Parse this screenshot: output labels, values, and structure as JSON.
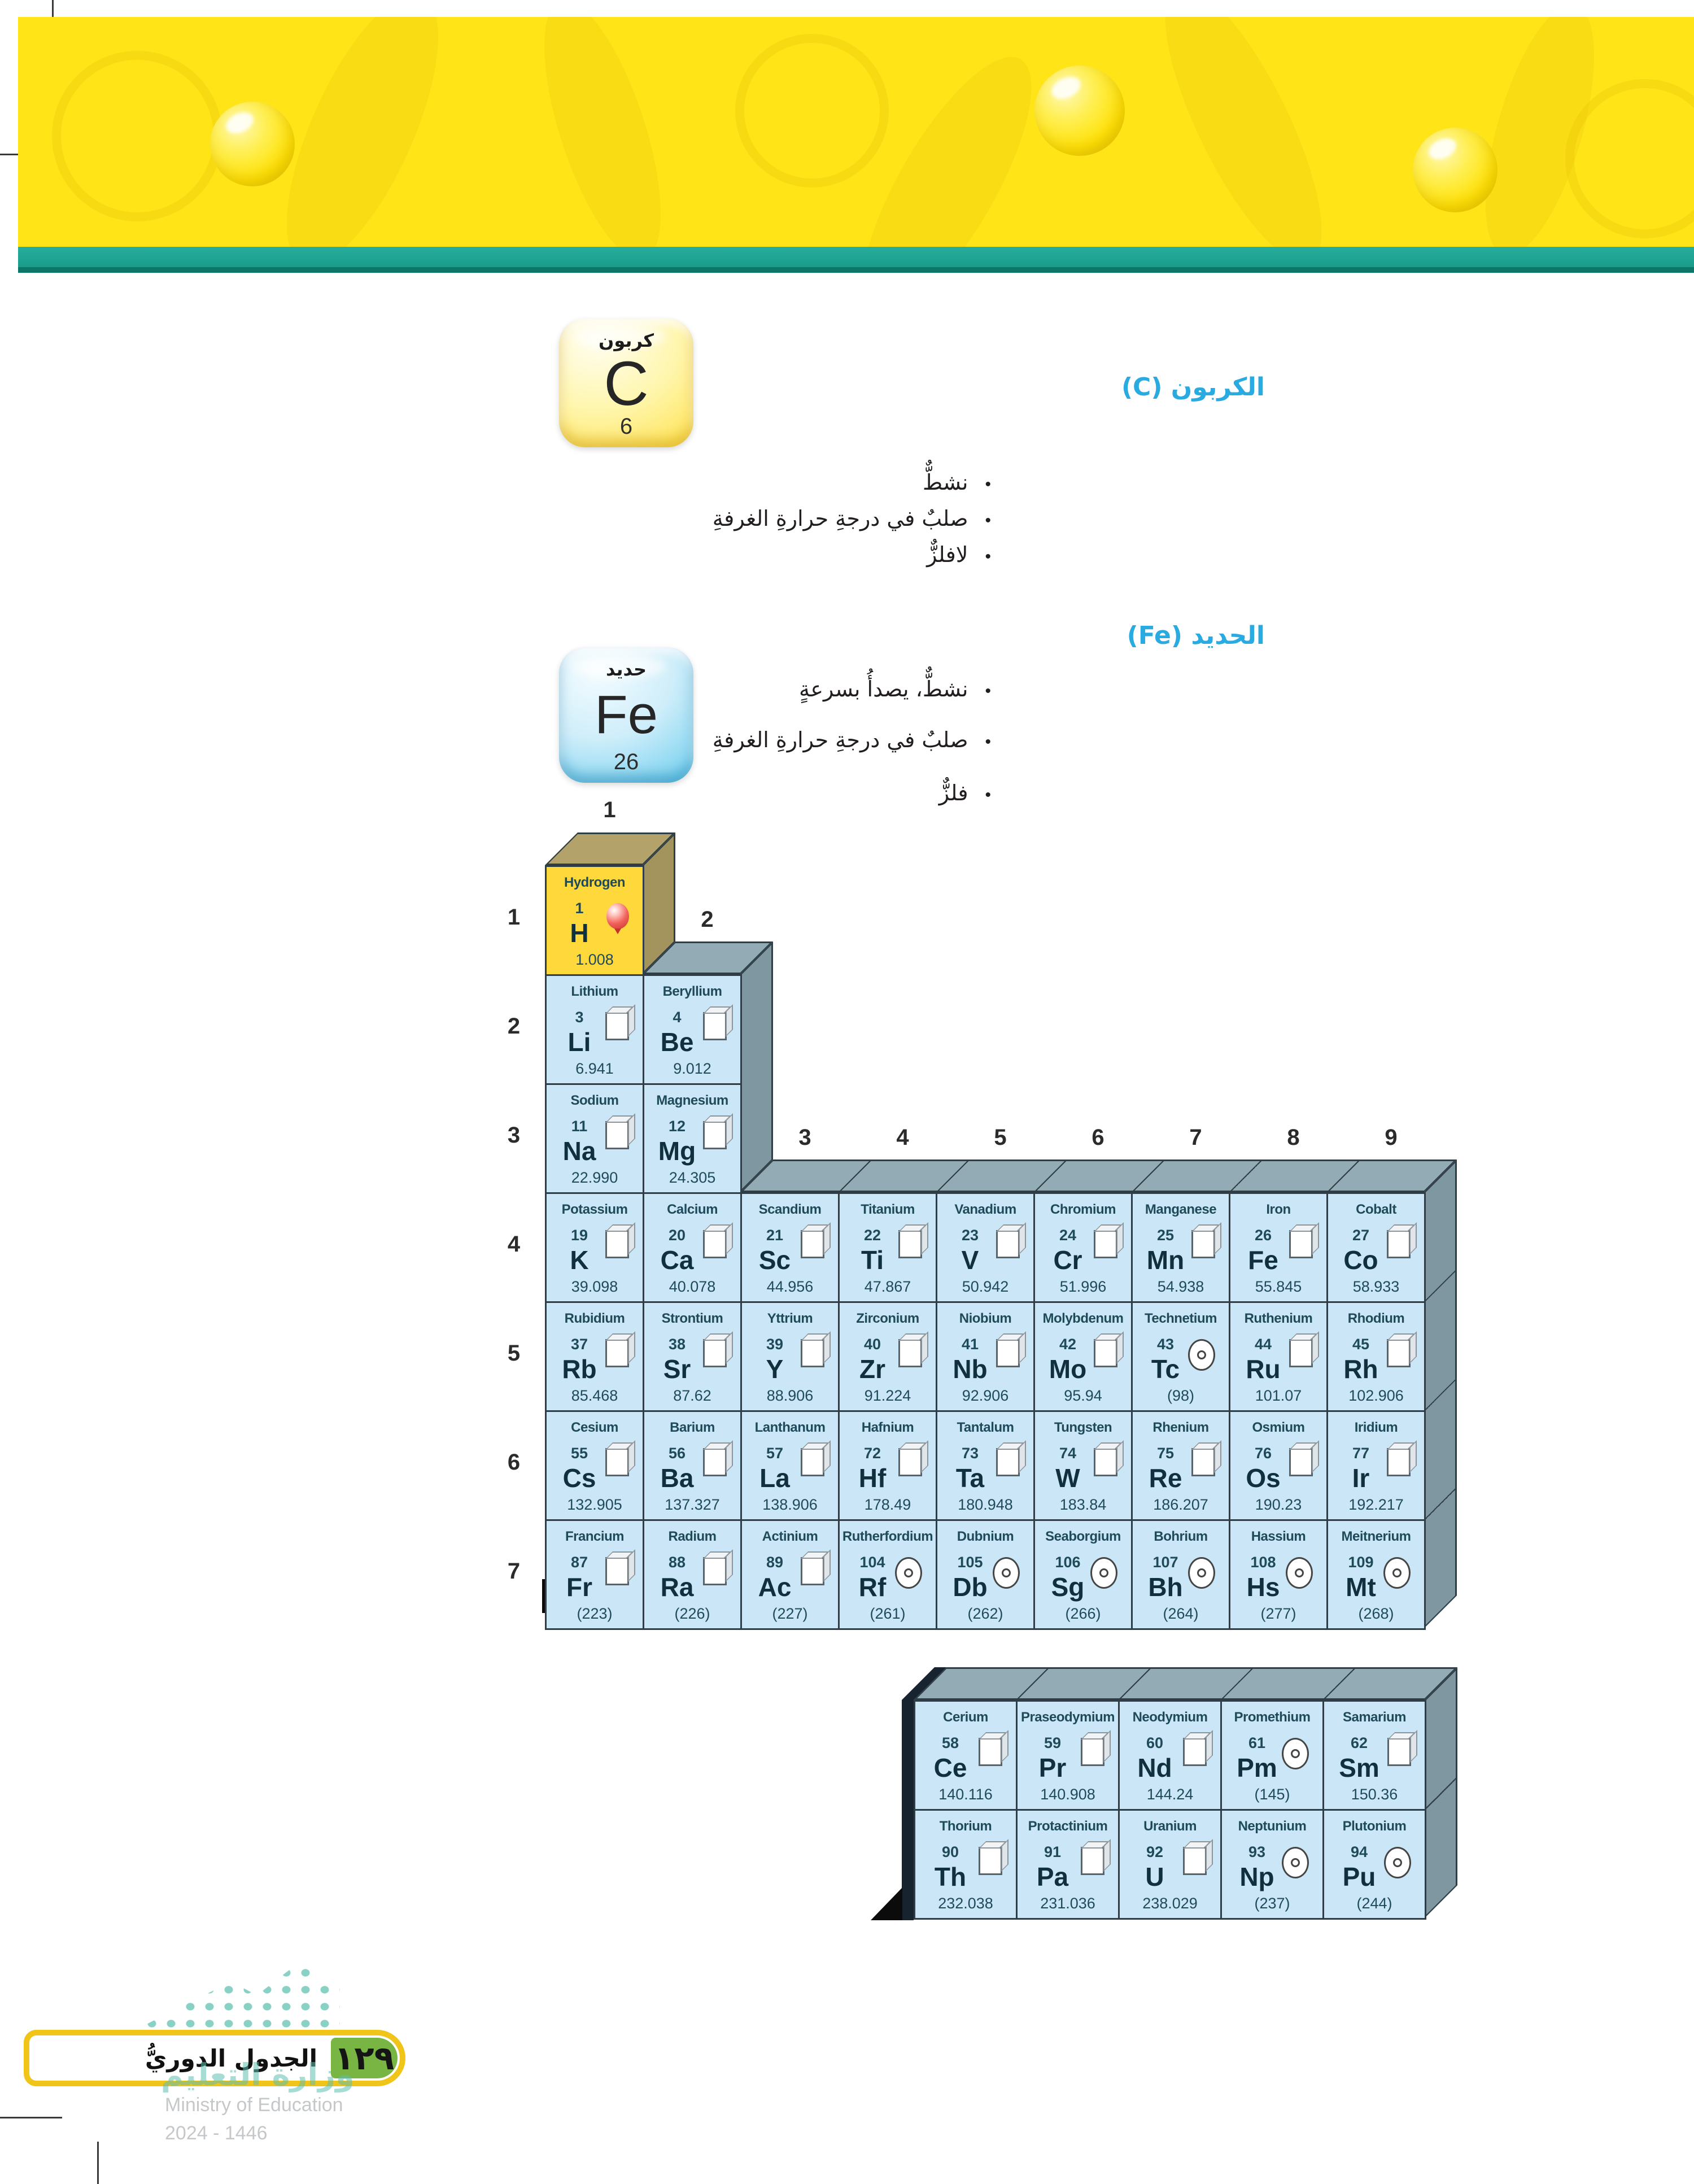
{
  "colors": {
    "banner_yellow": "#FFE418",
    "stripe_teal": "#1A9C8B",
    "heading_blue": "#29ABE2",
    "cell_blue": "#CBE7F7",
    "hydrogen_yellow": "#FFD83C",
    "table_3d_gray": "#93ABB5",
    "badge_green": "#79B543",
    "footer_border_yellow": "#F0C419"
  },
  "carbon_section": {
    "heading": "الكربون (C)",
    "bullets": [
      "نشطٌّ",
      "صلبٌ في درجةِ حرارةِ الغرفةِ",
      "لافلزٌّ"
    ],
    "card": {
      "name_ar": "كربون",
      "symbol": "C",
      "number": "6"
    }
  },
  "iron_section": {
    "heading": "الحديد (Fe)",
    "bullets": [
      "نشطٌّ، يصدأُ بسرعةٍ",
      "صلبٌ في درجةِ حرارةِ الغرفةِ",
      "فلزٌّ"
    ],
    "card": {
      "name_ar": "حديد",
      "symbol": "Fe",
      "number": "26"
    }
  },
  "periodic_table": {
    "group_labels": [
      "1",
      "2",
      "3",
      "4",
      "5",
      "6",
      "7",
      "8",
      "9"
    ],
    "period_labels": [
      "1",
      "2",
      "3",
      "4",
      "5",
      "6",
      "7"
    ],
    "legend_icons": [
      "solid-cube-icon",
      "gas-balloon-icon",
      "synthetic-bullseye-icon"
    ],
    "elements": [
      {
        "period": 1,
        "group": 1,
        "name": "Hydrogen",
        "number": "1",
        "symbol": "H",
        "mass": "1.008",
        "icon": "balloon",
        "variant": "yellow"
      },
      {
        "period": 2,
        "group": 1,
        "name": "Lithium",
        "number": "3",
        "symbol": "Li",
        "mass": "6.941",
        "icon": "cube"
      },
      {
        "period": 2,
        "group": 2,
        "name": "Beryllium",
        "number": "4",
        "symbol": "Be",
        "mass": "9.012",
        "icon": "cube"
      },
      {
        "period": 3,
        "group": 1,
        "name": "Sodium",
        "number": "11",
        "symbol": "Na",
        "mass": "22.990",
        "icon": "cube"
      },
      {
        "period": 3,
        "group": 2,
        "name": "Magnesium",
        "number": "12",
        "symbol": "Mg",
        "mass": "24.305",
        "icon": "cube"
      },
      {
        "period": 4,
        "group": 1,
        "name": "Potassium",
        "number": "19",
        "symbol": "K",
        "mass": "39.098",
        "icon": "cube"
      },
      {
        "period": 4,
        "group": 2,
        "name": "Calcium",
        "number": "20",
        "symbol": "Ca",
        "mass": "40.078",
        "icon": "cube"
      },
      {
        "period": 4,
        "group": 3,
        "name": "Scandium",
        "number": "21",
        "symbol": "Sc",
        "mass": "44.956",
        "icon": "cube"
      },
      {
        "period": 4,
        "group": 4,
        "name": "Titanium",
        "number": "22",
        "symbol": "Ti",
        "mass": "47.867",
        "icon": "cube"
      },
      {
        "period": 4,
        "group": 5,
        "name": "Vanadium",
        "number": "23",
        "symbol": "V",
        "mass": "50.942",
        "icon": "cube"
      },
      {
        "period": 4,
        "group": 6,
        "name": "Chromium",
        "number": "24",
        "symbol": "Cr",
        "mass": "51.996",
        "icon": "cube"
      },
      {
        "period": 4,
        "group": 7,
        "name": "Manganese",
        "number": "25",
        "symbol": "Mn",
        "mass": "54.938",
        "icon": "cube"
      },
      {
        "period": 4,
        "group": 8,
        "name": "Iron",
        "number": "26",
        "symbol": "Fe",
        "mass": "55.845",
        "icon": "cube"
      },
      {
        "period": 4,
        "group": 9,
        "name": "Cobalt",
        "number": "27",
        "symbol": "Co",
        "mass": "58.933",
        "icon": "cube"
      },
      {
        "period": 5,
        "group": 1,
        "name": "Rubidium",
        "number": "37",
        "symbol": "Rb",
        "mass": "85.468",
        "icon": "cube"
      },
      {
        "period": 5,
        "group": 2,
        "name": "Strontium",
        "number": "38",
        "symbol": "Sr",
        "mass": "87.62",
        "icon": "cube"
      },
      {
        "period": 5,
        "group": 3,
        "name": "Yttrium",
        "number": "39",
        "symbol": "Y",
        "mass": "88.906",
        "icon": "cube"
      },
      {
        "period": 5,
        "group": 4,
        "name": "Zirconium",
        "number": "40",
        "symbol": "Zr",
        "mass": "91.224",
        "icon": "cube"
      },
      {
        "period": 5,
        "group": 5,
        "name": "Niobium",
        "number": "41",
        "symbol": "Nb",
        "mass": "92.906",
        "icon": "cube"
      },
      {
        "period": 5,
        "group": 6,
        "name": "Molybdenum",
        "number": "42",
        "symbol": "Mo",
        "mass": "95.94",
        "icon": "cube"
      },
      {
        "period": 5,
        "group": 7,
        "name": "Technetium",
        "number": "43",
        "symbol": "Tc",
        "mass": "(98)",
        "icon": "bullseye"
      },
      {
        "period": 5,
        "group": 8,
        "name": "Ruthenium",
        "number": "44",
        "symbol": "Ru",
        "mass": "101.07",
        "icon": "cube"
      },
      {
        "period": 5,
        "group": 9,
        "name": "Rhodium",
        "number": "45",
        "symbol": "Rh",
        "mass": "102.906",
        "icon": "cube"
      },
      {
        "period": 6,
        "group": 1,
        "name": "Cesium",
        "number": "55",
        "symbol": "Cs",
        "mass": "132.905",
        "icon": "cube"
      },
      {
        "period": 6,
        "group": 2,
        "name": "Barium",
        "number": "56",
        "symbol": "Ba",
        "mass": "137.327",
        "icon": "cube"
      },
      {
        "period": 6,
        "group": 3,
        "name": "Lanthanum",
        "number": "57",
        "symbol": "La",
        "mass": "138.906",
        "icon": "cube"
      },
      {
        "period": 6,
        "group": 4,
        "name": "Hafnium",
        "number": "72",
        "symbol": "Hf",
        "mass": "178.49",
        "icon": "cube"
      },
      {
        "period": 6,
        "group": 5,
        "name": "Tantalum",
        "number": "73",
        "symbol": "Ta",
        "mass": "180.948",
        "icon": "cube"
      },
      {
        "period": 6,
        "group": 6,
        "name": "Tungsten",
        "number": "74",
        "symbol": "W",
        "mass": "183.84",
        "icon": "cube"
      },
      {
        "period": 6,
        "group": 7,
        "name": "Rhenium",
        "number": "75",
        "symbol": "Re",
        "mass": "186.207",
        "icon": "cube"
      },
      {
        "period": 6,
        "group": 8,
        "name": "Osmium",
        "number": "76",
        "symbol": "Os",
        "mass": "190.23",
        "icon": "cube"
      },
      {
        "period": 6,
        "group": 9,
        "name": "Iridium",
        "number": "77",
        "symbol": "Ir",
        "mass": "192.217",
        "icon": "cube"
      },
      {
        "period": 7,
        "group": 1,
        "name": "Francium",
        "number": "87",
        "symbol": "Fr",
        "mass": "(223)",
        "icon": "cube"
      },
      {
        "period": 7,
        "group": 2,
        "name": "Radium",
        "number": "88",
        "symbol": "Ra",
        "mass": "(226)",
        "icon": "cube"
      },
      {
        "period": 7,
        "group": 3,
        "name": "Actinium",
        "number": "89",
        "symbol": "Ac",
        "mass": "(227)",
        "icon": "cube"
      },
      {
        "period": 7,
        "group": 4,
        "name": "Rutherfordium",
        "number": "104",
        "symbol": "Rf",
        "mass": "(261)",
        "icon": "bullseye"
      },
      {
        "period": 7,
        "group": 5,
        "name": "Dubnium",
        "number": "105",
        "symbol": "Db",
        "mass": "(262)",
        "icon": "bullseye"
      },
      {
        "period": 7,
        "group": 6,
        "name": "Seaborgium",
        "number": "106",
        "symbol": "Sg",
        "mass": "(266)",
        "icon": "bullseye"
      },
      {
        "period": 7,
        "group": 7,
        "name": "Bohrium",
        "number": "107",
        "symbol": "Bh",
        "mass": "(264)",
        "icon": "bullseye"
      },
      {
        "period": 7,
        "group": 8,
        "name": "Hassium",
        "number": "108",
        "symbol": "Hs",
        "mass": "(277)",
        "icon": "bullseye"
      },
      {
        "period": 7,
        "group": 9,
        "name": "Meitnerium",
        "number": "109",
        "symbol": "Mt",
        "mass": "(268)",
        "icon": "bullseye"
      }
    ],
    "inner_series": {
      "lanthanides": [
        {
          "name": "Cerium",
          "number": "58",
          "symbol": "Ce",
          "mass": "140.116",
          "icon": "cube"
        },
        {
          "name": "Praseodymium",
          "number": "59",
          "symbol": "Pr",
          "mass": "140.908",
          "icon": "cube"
        },
        {
          "name": "Neodymium",
          "number": "60",
          "symbol": "Nd",
          "mass": "144.24",
          "icon": "cube"
        },
        {
          "name": "Promethium",
          "number": "61",
          "symbol": "Pm",
          "mass": "(145)",
          "icon": "bullseye"
        },
        {
          "name": "Samarium",
          "number": "62",
          "symbol": "Sm",
          "mass": "150.36",
          "icon": "cube"
        }
      ],
      "actinides": [
        {
          "name": "Thorium",
          "number": "90",
          "symbol": "Th",
          "mass": "232.038",
          "icon": "cube"
        },
        {
          "name": "Protactinium",
          "number": "91",
          "symbol": "Pa",
          "mass": "231.036",
          "icon": "cube"
        },
        {
          "name": "Uranium",
          "number": "92",
          "symbol": "U",
          "mass": "238.029",
          "icon": "cube"
        },
        {
          "name": "Neptunium",
          "number": "93",
          "symbol": "Np",
          "mass": "(237)",
          "icon": "bullseye"
        },
        {
          "name": "Plutonium",
          "number": "94",
          "symbol": "Pu",
          "mass": "(244)",
          "icon": "bullseye"
        }
      ]
    }
  },
  "footer": {
    "section_title": "الجدول الدوريُّ",
    "page_number_arabic": "١٢٩",
    "watermark_ar": "وزارة التعليم",
    "watermark_en": "Ministry of Education",
    "watermark_year": "2024 - 1446"
  }
}
